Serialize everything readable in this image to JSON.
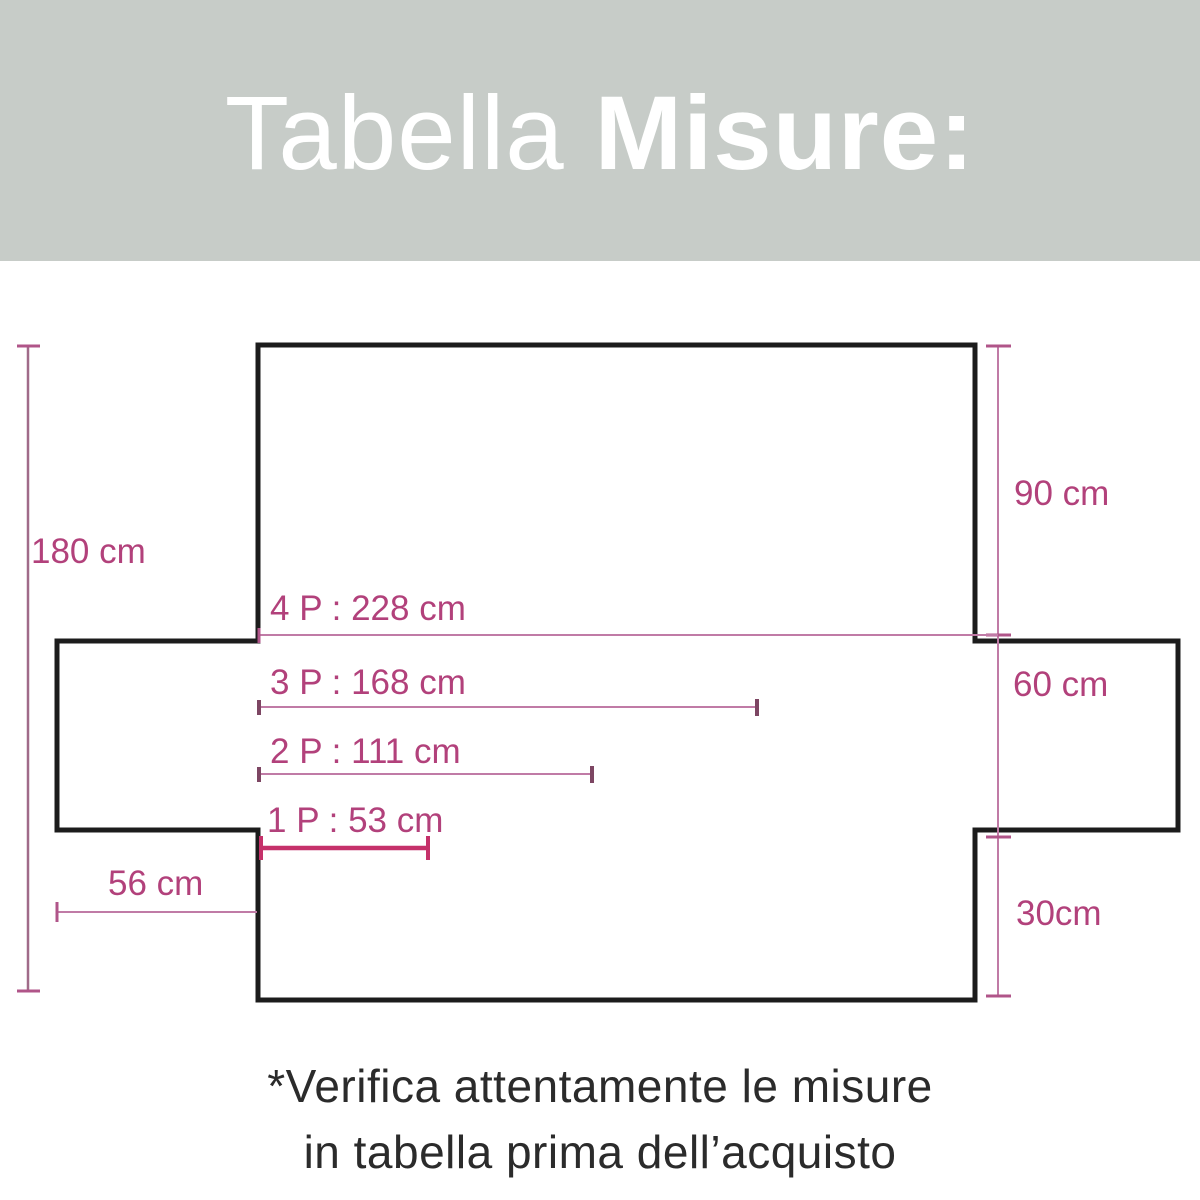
{
  "header": {
    "title_regular": "Tabella",
    "title_bold": "Misure:",
    "bg_color": "#c7ccc8",
    "text_color": "#ffffff"
  },
  "diagram": {
    "accent_text_color": "#b2417b",
    "outline_color": "#1c1c1c",
    "dim_line_color": "#c07ba6",
    "strong_line_color": "#c5316a",
    "labels": {
      "total_height": "180 cm",
      "back_height": "90 cm",
      "seat_depth": "60 cm",
      "front_drop": "30cm",
      "arm_width": "56 cm",
      "seats_4": "4 P : 228 cm",
      "seats_3": "3 P : 168 cm",
      "seats_2": "2 P : 111 cm",
      "seats_1": "1 P : 53 cm"
    }
  },
  "footer": {
    "note_line1": "*Verifica attentamente le misure",
    "note_line2": "in tabella prima dell’acquisto"
  }
}
